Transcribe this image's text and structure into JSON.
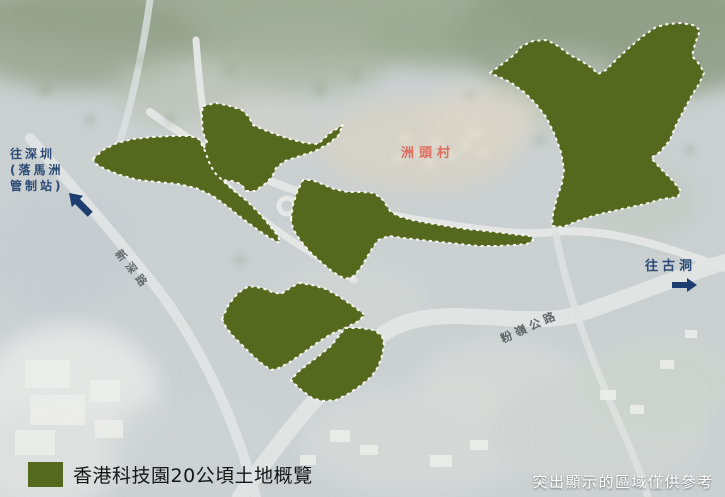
{
  "map": {
    "colors": {
      "highlight_fill": "#55691e",
      "highlight_border": "#fafaf0",
      "label_blue": "#2b4a75",
      "arrow_blue": "#1d3e70",
      "village_red": "#e15a4b",
      "road_label_gray": "#4a5054",
      "legend_text": "#161616",
      "disclaimer_text": "#ffffff"
    },
    "labels": {
      "to_shenzhen_line1": "往深圳",
      "to_shenzhen_line2": "(落馬洲",
      "to_shenzhen_line3": "管制站)",
      "village": "洲頭村",
      "san_sham_road": "新深路",
      "fanling_highway": "粉嶺公路",
      "to_kwu_tung": "往古洞"
    },
    "legend": {
      "label": "香港科技園20公頃土地概覽"
    },
    "disclaimer": "突出顯示的區域僅供參考",
    "areas": [
      {
        "name": "highlight-area-northeast",
        "points": "490,73 505,62 514,55 522,46 533,41 547,40 558,46 570,55 583,62 592,68 598,74 606,70 618,58 630,47 643,36 656,27 668,24 681,23 693,25 700,30 695,44 692,56 700,65 704,73 699,84 692,95 684,110 676,125 670,140 660,152 651,158 662,170 673,181 680,190 678,197 662,199 645,204 622,209 600,214 580,220 563,227 552,226 553,214 557,198 562,183 564,170 561,152 554,133 546,117 536,104 524,92 510,82 497,76"
      },
      {
        "name": "highlight-area-upper-middle",
        "points": "203,106 216,103 230,106 242,110 249,117 253,125 262,129 275,134 290,139 305,143 318,144 330,133 343,125 338,136 328,144 315,151 300,156 285,161 276,168 272,177 265,184 255,191 246,191 241,184 232,181 221,180 212,176 208,167 205,157 203,149 207,142 203,133 202,120 202,112"
      },
      {
        "name": "highlight-area-west-band",
        "points": "93,159 103,150 117,143 133,139 152,137 172,136 190,136 199,139 205,151 209,162 214,172 222,180 233,190 247,201 259,213 270,226 278,236 280,243 270,238 258,230 243,219 228,207 213,196 196,188 178,184 158,182 138,180 120,175 105,169 96,164"
      },
      {
        "name": "highlight-area-central",
        "points": "291,219 293,205 297,192 303,180 312,180 322,184 334,189 348,192 362,192 374,193 383,200 390,211 398,216 412,220 428,223 447,226 466,229 486,231 504,233 520,235 531,236 533,240 527,244 514,245 497,246 478,246 459,244 440,242 421,240 403,238 389,236 378,240 370,252 362,266 354,276 345,279 333,272 322,263 310,252 300,240 293,229"
      },
      {
        "name": "highlight-area-south",
        "points": "222,319 229,304 238,293 249,286 262,288 272,292 281,294 290,288 299,283 312,285 326,289 340,297 353,306 365,315 357,322 345,328 331,334 317,343 303,353 290,362 279,368 271,370 261,363 252,355 242,345 233,336 226,327"
      },
      {
        "name": "highlight-area-south-small",
        "points": "345,328 360,328 374,330 382,336 384,345 382,356 378,367 371,377 360,386 348,394 336,400 323,401 312,398 300,389 291,380 298,372 308,364 320,355 331,346 338,337"
      }
    ]
  }
}
